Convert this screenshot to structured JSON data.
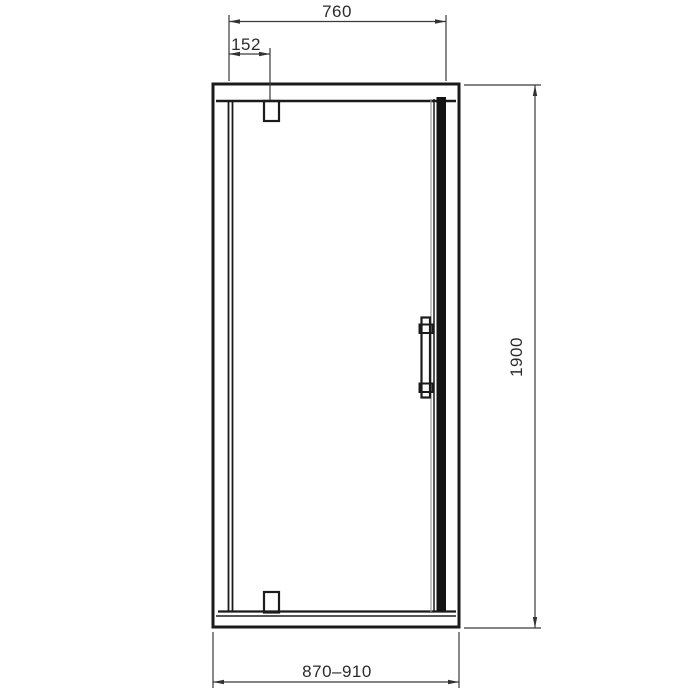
{
  "dimensions": {
    "door_width": "760",
    "pivot_offset": "152",
    "height": "1900",
    "overall_width_range": "870–910"
  },
  "colors": {
    "background": "#ffffff",
    "drawing_line": "#1b1b1b",
    "dimension_line": "#3a3a3a",
    "text": "#2b2b2b"
  }
}
